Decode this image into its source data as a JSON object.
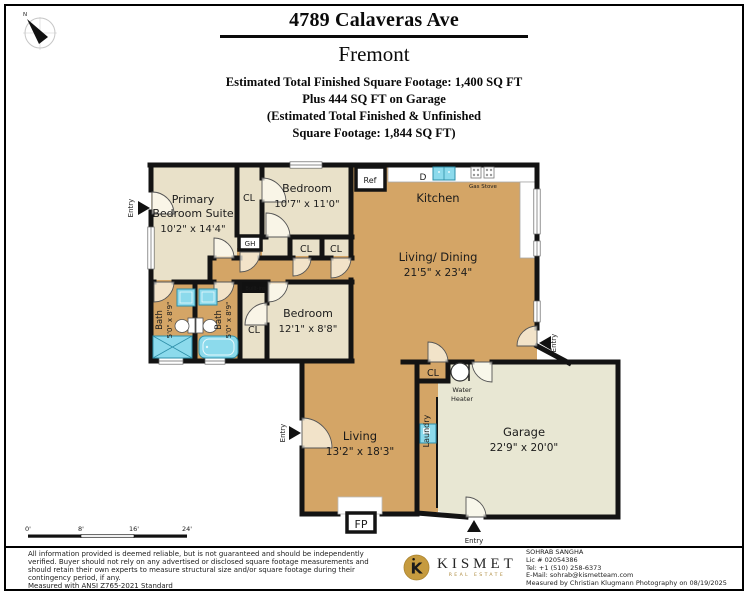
{
  "header": {
    "address": "4789 Calaveras Ave",
    "city": "Fremont",
    "sqft_line1": "Estimated Total Finished Square Footage: 1,400 SQ FT",
    "sqft_line2": "Plus 444 SQ FT on Garage",
    "sqft_line3": "(Estimated Total Finished & Unfinished",
    "sqft_line4": "Square Footage: 1,844 SQ FT)"
  },
  "compass": {
    "north_label": "N"
  },
  "plan": {
    "rooms": {
      "primary_suite": {
        "line1": "Primary",
        "line2": "Bedroom Suite",
        "dims": "10'2\" x 14'4\""
      },
      "bedroom_top": {
        "name": "Bedroom",
        "dims": "10'7\" x 11'0\""
      },
      "kitchen": {
        "name": "Kitchen"
      },
      "living_dining": {
        "name": "Living/ Dining",
        "dims": "21'5\" x 23'4\""
      },
      "bedroom_mid": {
        "name": "Bedroom",
        "dims": "12'1\" x 8'8\""
      },
      "bath": {
        "name": "Bath",
        "dims": "5'0\" x 8'9\""
      },
      "living": {
        "name": "Living",
        "dims": "13'2\" x 18'3\""
      },
      "garage": {
        "name": "Garage",
        "dims": "22'9\" x 20'0\""
      },
      "laundry": {
        "name": "Laundry"
      }
    },
    "labels": {
      "closet": "CL",
      "gh": "GH",
      "ref": "Ref",
      "dishwasher": "D",
      "gas_stove": "Gas Stove",
      "built_ins": "Built-ins",
      "fireplace": "FP",
      "water_heater_line1": "Water",
      "water_heater_line2": "Heater",
      "entry": "Entry"
    },
    "scale_bar": {
      "ticks": [
        "0'",
        "8'",
        "16'",
        "24'"
      ]
    }
  },
  "footer": {
    "disclaimer": [
      "All information provided is deemed reliable, but is not guaranteed and should be independently",
      "verified. Buyer should not rely on any advertised or disclosed square footage measurements and",
      "should retain their own experts to measure structural size and/or square footage during their",
      "contingency period, if any.",
      "Measured with ANSI Z765-2021 Standard"
    ],
    "brand": {
      "monogram": "K",
      "name": "KISMET",
      "tagline": "REAL ESTATE"
    },
    "agent": {
      "name": "SOHRAB SANGHA",
      "license": "Lic # 02054386",
      "phone": "Tel: +1 (510) 258-6373",
      "email": "E-Mail: sohrab@kismetteam.com",
      "measured": "Measured by Christian Klugmann Photography on 08/19/2025"
    }
  },
  "colors": {
    "wall": "#131313",
    "room_tan": "#d4a566",
    "room_beige": "#e9e1c9",
    "garage_sage": "#e8e7d3",
    "fixture_cyan": "#8cdaec",
    "brand_gold": "#c69b3f"
  }
}
